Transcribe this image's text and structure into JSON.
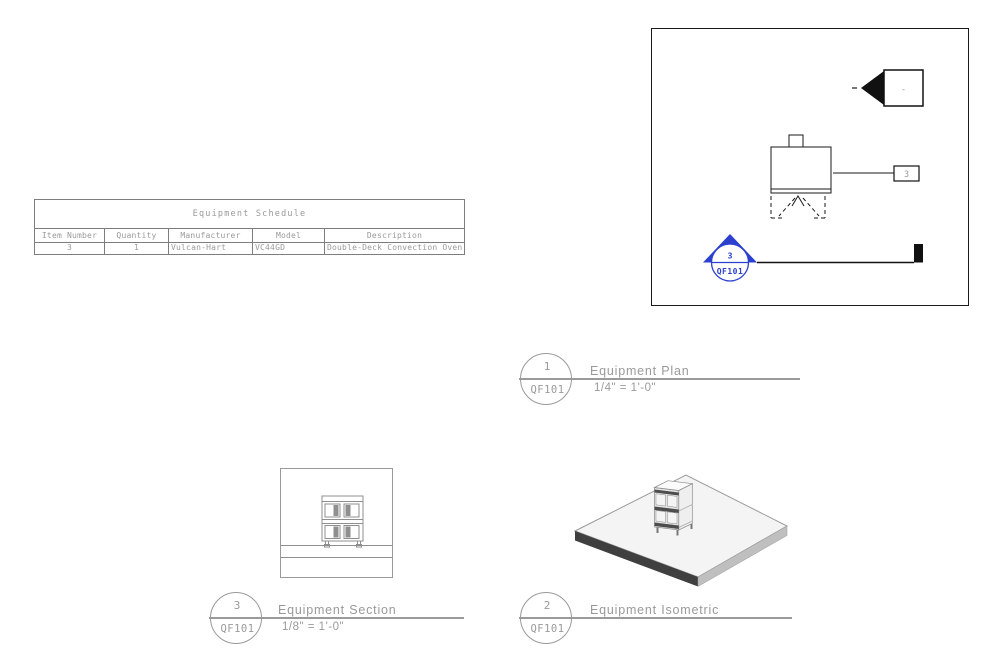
{
  "colors": {
    "annotation_gray": "#9a9a9a",
    "line_black": "#1a1a1a",
    "callout_blue": "#2b40cf"
  },
  "schedule": {
    "title": "Equipment Schedule",
    "columns": [
      "Item Number",
      "Quantity",
      "Manufacturer",
      "Model",
      "Description"
    ],
    "rows": [
      [
        "3",
        "1",
        "Vulcan-Hart",
        "VC44GD",
        "Double-Deck Convection Oven"
      ]
    ]
  },
  "plan": {
    "section_marker": {
      "label": "-"
    },
    "equipment_tag": {
      "label": "3"
    },
    "callout": {
      "detail": "3",
      "sheet": "QF101"
    }
  },
  "views": {
    "plan": {
      "detail": "1",
      "sheet": "QF101",
      "name": "Equipment Plan",
      "scale": "1/4\" = 1'-0\""
    },
    "isometric": {
      "detail": "2",
      "sheet": "QF101",
      "name": "Equipment Isometric"
    },
    "section": {
      "detail": "3",
      "sheet": "QF101",
      "name": "Equipment Section",
      "scale": "1/8\" = 1'-0\""
    }
  }
}
